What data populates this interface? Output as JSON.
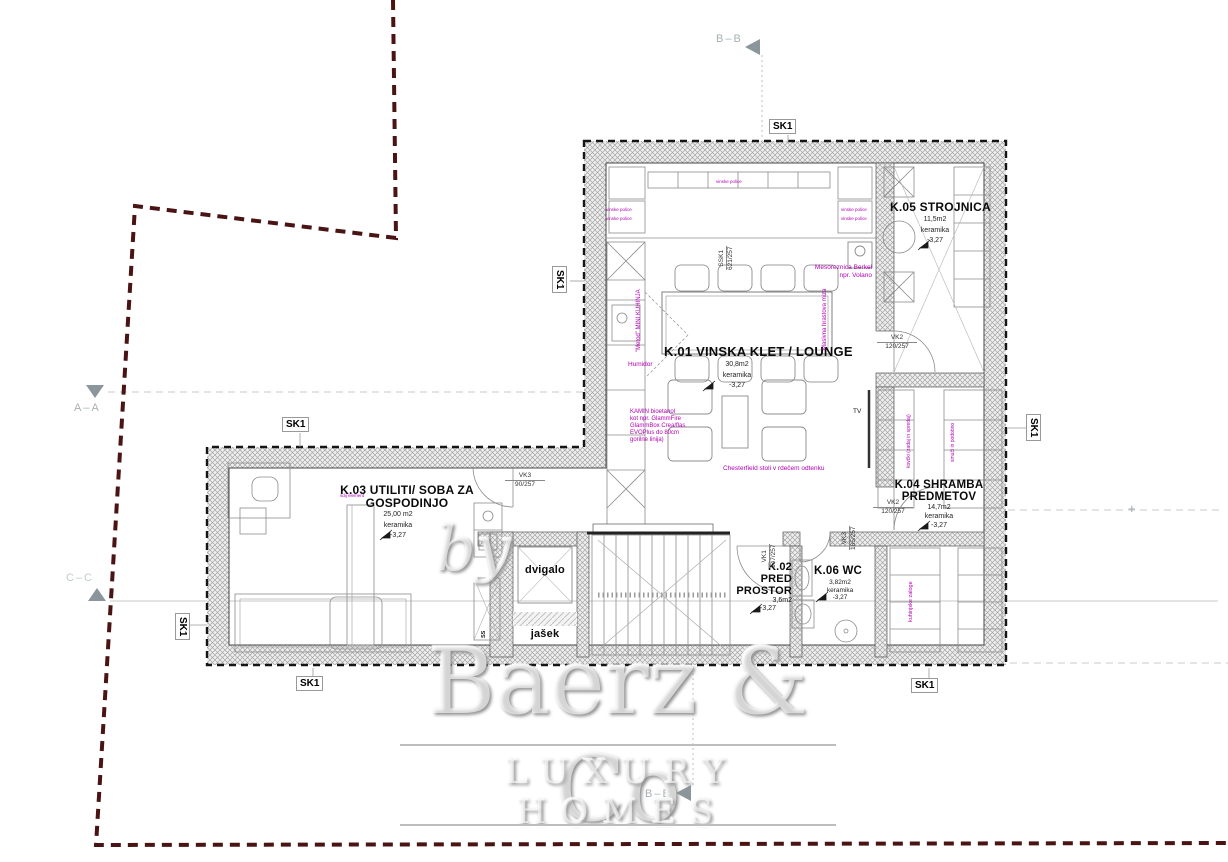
{
  "colors": {
    "boundary": "#4a1414",
    "magenta": "#b400b4",
    "marker_gray": "#9aa7ae",
    "wall_hatch": "#a5a5a5"
  },
  "watermark": {
    "by": "by",
    "brand": "Baerz & Co",
    "tagline": "LUXURY HOMES"
  },
  "markers": {
    "sk1": "SK1",
    "bb": "B–B",
    "aa": "A–A",
    "cc": "C–C",
    "plus": "+"
  },
  "rooms": {
    "k01": {
      "title": "K.01 VINSKA KLET / LOUNGE",
      "area": "30,8m2",
      "finish": "keramika",
      "level": "-3,27"
    },
    "k02": {
      "l1": "K.02",
      "l2": "PRED",
      "l3": "PROSTOR",
      "area": "3,6m2",
      "level": "-3,27"
    },
    "k03": {
      "l1": "K.03 UTILITI/ SOBA ZA",
      "l2": "GOSPODINJO",
      "area": "25,00 m2",
      "finish": "keramika",
      "level": "-3,27"
    },
    "k04": {
      "l1": "K.04 SHRAMBA",
      "l2": "PREDMETOV",
      "area": "14,7m2",
      "finish": "keramika",
      "level": "-3,27"
    },
    "k05": {
      "title": "K.05 STROJNICA",
      "area": "11,5m2",
      "finish": "keramika",
      "level": "-3,27"
    },
    "k06": {
      "title": "K.06 WC",
      "area": "3,82m2",
      "finish": "keramika",
      "level": "-3,27"
    },
    "dvigalo": "dvigalo",
    "jasek": "jašek"
  },
  "openings": {
    "vk3a": {
      "code": "VK3",
      "size": "90/257"
    },
    "vk2a": {
      "code": "VK2",
      "size": "120/257"
    },
    "vk2b": {
      "code": "VK2",
      "size": "120/257"
    },
    "vk1": {
      "code": "VK1",
      "size": "147/257"
    },
    "vk3b": {
      "code": "VK3",
      "size": "165/257"
    },
    "ssk1": {
      "code": "SSK1",
      "size": "621/257"
    }
  },
  "notes": {
    "berkel1": "Mesoreznica Berkel",
    "berkel2": "npr. Volano",
    "humidor": "Humidor",
    "kamin1": "KAMIN bioetanol",
    "kamin2": "kot npr. GlammFire",
    "kamin3": "GlammBox Crea/flas",
    "kamin4": "EVOPlus do 80cm",
    "kamin5": "gorilne linija)",
    "chesterfield": "Chesterfield stoli v rdečem odtenku",
    "miza": "Masivna hrastova miza",
    "kuhinja": "\"Metod\" MINI KUHINJA",
    "kovcki": "kovčki (zadaj in spredaj)",
    "smuci": "smuči in podobno",
    "zaloge": "kuhinjske zaloge",
    "element": "sdij element",
    "police": "vinske police",
    "tv": "TV",
    "ss": "SS"
  }
}
